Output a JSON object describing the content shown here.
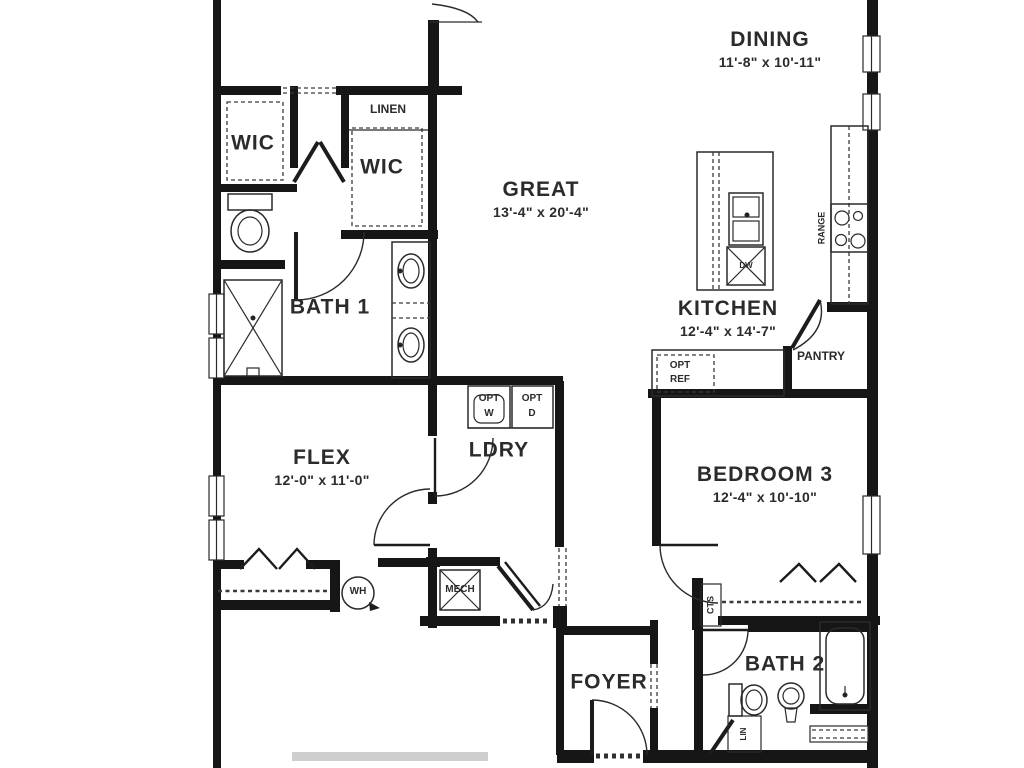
{
  "plan": {
    "rooms": [
      {
        "id": "dining",
        "name": "DINING",
        "dims": "11'-8\" x 10'-11\""
      },
      {
        "id": "great",
        "name": "GREAT",
        "dims": "13'-4\" x 20'-4\""
      },
      {
        "id": "kitchen",
        "name": "KITCHEN",
        "dims": "12'-4\" x 14'-7\""
      },
      {
        "id": "flex",
        "name": "FLEX",
        "dims": "12'-0\" x 11'-0\""
      },
      {
        "id": "bedroom3",
        "name": "BEDROOM 3",
        "dims": "12'-4\" x 10'-10\""
      },
      {
        "id": "bath1",
        "name": "BATH 1"
      },
      {
        "id": "bath2",
        "name": "BATH 2"
      },
      {
        "id": "foyer",
        "name": "FOYER"
      },
      {
        "id": "ldry",
        "name": "LDRY"
      },
      {
        "id": "wic-left",
        "name": "WIC"
      },
      {
        "id": "wic-right",
        "name": "WIC"
      }
    ],
    "labels": {
      "linen": "LINEN",
      "pantry": "PANTRY",
      "range": "RANGE",
      "mech": "MECH",
      "wh": "WH",
      "dw": "DW",
      "cts": "CTS",
      "lin": "LIN",
      "opt_ref": [
        "OPT",
        "REF"
      ],
      "opt_w": [
        "OPT",
        "W"
      ],
      "opt_d": [
        "OPT",
        "D"
      ]
    },
    "colors": {
      "wall": "#161616",
      "text": "#2b2b2b",
      "background": "#ffffff"
    }
  }
}
